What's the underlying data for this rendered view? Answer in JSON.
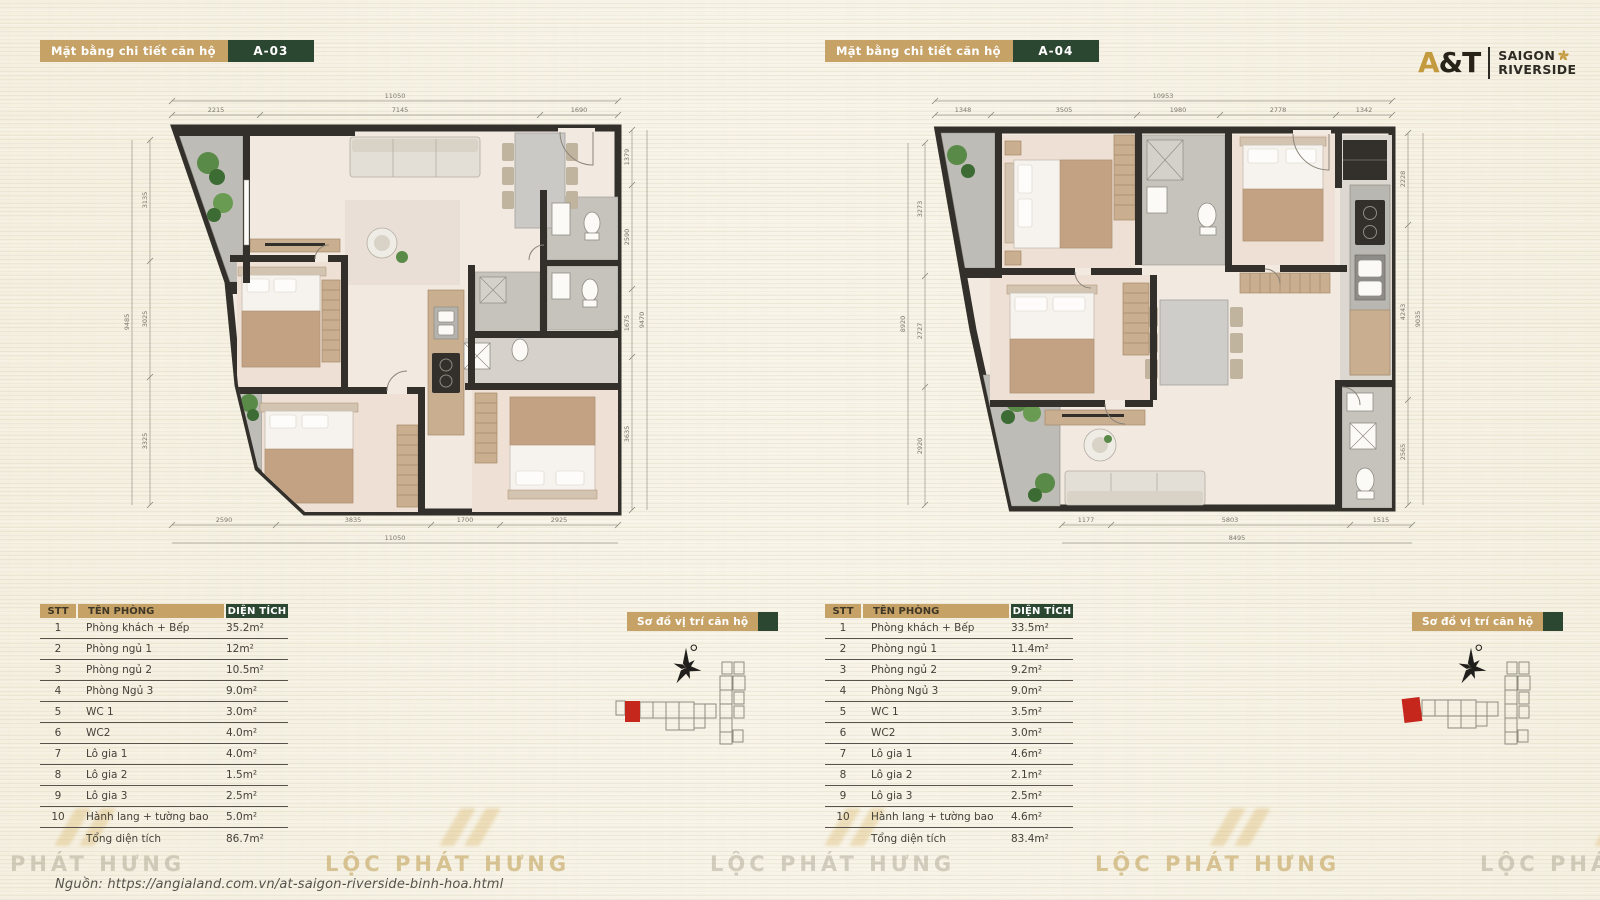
{
  "colors": {
    "accent_tan": "#c6a267",
    "accent_green": "#2c4731",
    "highlight_red": "#c5271c",
    "watermark_gold": "#d9b25f",
    "wall_dark": "#33302b"
  },
  "logo": {
    "at": "A&T",
    "name_line1": "SAIGON",
    "name_line2": "RIVERSIDE"
  },
  "page": {
    "source_note": "Nguồn:  https://angialand.com.vn/at-saigon-riverside-binh-hoa.html",
    "watermark_text": "LỘC PHÁT HƯNG"
  },
  "units": [
    {
      "header_label": "Mặt bằng chi tiết căn hộ",
      "unit_code": "A-03",
      "location_label": "Sơ đồ vị trí căn hộ",
      "dims": {
        "top_total": "11050",
        "top": [
          "2215",
          "7145",
          "1690"
        ],
        "bottom": [
          "2590",
          "3835",
          "1700",
          "2925"
        ],
        "bottom_total": "11050",
        "left": [
          "3135",
          "3025",
          "3325"
        ],
        "left_total": "9485",
        "right": [
          "1379",
          "2590",
          "1675",
          "3635"
        ],
        "right_total": "9470"
      },
      "table": {
        "headers": [
          "STT",
          "TÊN PHÒNG",
          "DIỆN TÍCH"
        ],
        "rows": [
          [
            "1",
            "Phòng khách + Bếp",
            "35.2m²"
          ],
          [
            "2",
            "Phòng ngủ 1",
            "12m²"
          ],
          [
            "3",
            "Phòng ngủ 2",
            "10.5m²"
          ],
          [
            "4",
            "Phòng Ngủ 3",
            "9.0m²"
          ],
          [
            "5",
            "WC 1",
            "3.0m²"
          ],
          [
            "6",
            "WC2",
            "4.0m²"
          ],
          [
            "7",
            "Lô gia 1",
            "4.0m²"
          ],
          [
            "8",
            "Lô gia 2",
            "1.5m²"
          ],
          [
            "9",
            "Lô gia 3",
            "2.5m²"
          ],
          [
            "10",
            "Hành lang + tường bao",
            "5.0m²"
          ]
        ],
        "total_label": "Tổng diện tích",
        "total_value": "86.7m²"
      }
    },
    {
      "header_label": "Mặt bằng chi tiết căn hộ",
      "unit_code": "A-04",
      "location_label": "Sơ đồ vị trí căn hộ",
      "dims": {
        "top_total": "10953",
        "top": [
          "1348",
          "3505",
          "1980",
          "2778",
          "1342"
        ],
        "bottom": [
          "1177",
          "5803",
          "1515"
        ],
        "bottom_total": "8495",
        "left": [
          "3273",
          "2727",
          "2920"
        ],
        "left_total": "8920",
        "right": [
          "2228",
          "4243",
          "2565"
        ],
        "right_total": "9035"
      },
      "table": {
        "headers": [
          "STT",
          "TÊN PHÒNG",
          "DIỆN TÍCH"
        ],
        "rows": [
          [
            "1",
            "Phòng khách + Bếp",
            "33.5m²"
          ],
          [
            "2",
            "Phòng ngủ 1",
            "11.4m²"
          ],
          [
            "3",
            "Phòng ngủ 2",
            "9.2m²"
          ],
          [
            "4",
            "Phòng Ngủ 3",
            "9.0m²"
          ],
          [
            "5",
            "WC 1",
            "3.5m²"
          ],
          [
            "6",
            "WC2",
            "3.0m²"
          ],
          [
            "7",
            "Lô gia 1",
            "4.6m²"
          ],
          [
            "8",
            "Lô gia 2",
            "2.1m²"
          ],
          [
            "9",
            "Lô gia 3",
            "2.5m²"
          ],
          [
            "10",
            "Hành lang + tường bao",
            "4.6m²"
          ]
        ],
        "total_label": "Tổng diện tích",
        "total_value": "83.4m²"
      }
    }
  ]
}
